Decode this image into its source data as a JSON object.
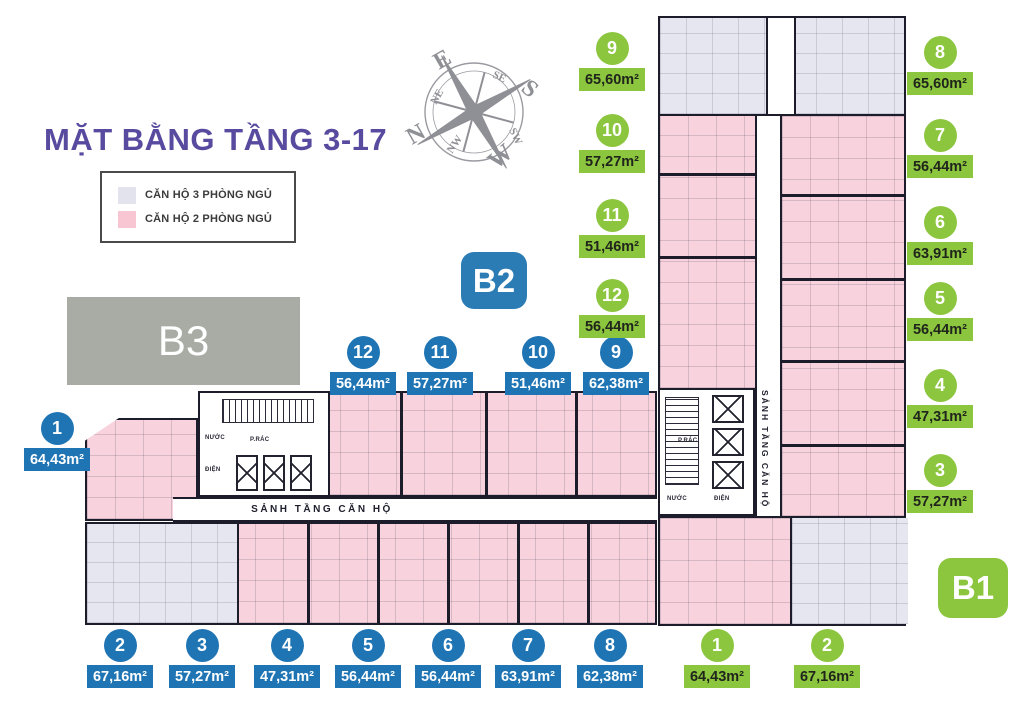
{
  "title": "MẶT BẰNG TẦNG 3-17",
  "legend": {
    "items": [
      {
        "label": "CĂN HỘ 3 PHÒNG NGỦ",
        "color": "#e3e3ee"
      },
      {
        "label": "CĂN HỘ 2 PHÒNG NGỦ",
        "color": "#f8c5d2"
      }
    ]
  },
  "compass": {
    "n": "N",
    "e": "E",
    "s": "S",
    "w": "W",
    "ne": "NE",
    "se": "SE",
    "sw": "SW",
    "nw": "NW"
  },
  "blocks": {
    "b1": "B1",
    "b2": "B2",
    "b3": "B3"
  },
  "corridor_label": "SẢNH TẦNG CĂN HỘ",
  "core_rooms": {
    "trash": "P.RÁC",
    "water": "NƯỚC",
    "electric": "ĐIỆN"
  },
  "colors": {
    "accent_blue": "#1f74b4",
    "accent_green": "#8cc63e",
    "title_purple": "#584a9e",
    "pink_2br": "#f8d3dd",
    "lavender_3br": "#e6e6f0",
    "gray_b3": "#a9aca4"
  },
  "tower_b2": {
    "label": "B2",
    "units": [
      {
        "no": "1",
        "area": "64,43m²"
      },
      {
        "no": "2",
        "area": "67,16m²"
      },
      {
        "no": "3",
        "area": "57,27m²"
      },
      {
        "no": "4",
        "area": "47,31m²"
      },
      {
        "no": "5",
        "area": "56,44m²"
      },
      {
        "no": "6",
        "area": "56,44m²"
      },
      {
        "no": "7",
        "area": "63,91m²"
      },
      {
        "no": "8",
        "area": "62,38m²"
      },
      {
        "no": "9",
        "area": "62,38m²"
      },
      {
        "no": "10",
        "area": "51,46m²"
      },
      {
        "no": "11",
        "area": "57,27m²"
      },
      {
        "no": "12",
        "area": "56,44m²"
      }
    ]
  },
  "tower_b1": {
    "label": "B1",
    "units": [
      {
        "no": "1",
        "area": "64,43m²"
      },
      {
        "no": "2",
        "area": "67,16m²"
      },
      {
        "no": "3",
        "area": "57,27m²"
      },
      {
        "no": "4",
        "area": "47,31m²"
      },
      {
        "no": "5",
        "area": "56,44m²"
      },
      {
        "no": "6",
        "area": "63,91m²"
      },
      {
        "no": "7",
        "area": "56,44m²"
      },
      {
        "no": "8",
        "area": "65,60m²"
      },
      {
        "no": "9",
        "area": "65,60m²"
      },
      {
        "no": "10",
        "area": "57,27m²"
      },
      {
        "no": "11",
        "area": "51,46m²"
      },
      {
        "no": "12",
        "area": "56,44m²"
      }
    ]
  }
}
